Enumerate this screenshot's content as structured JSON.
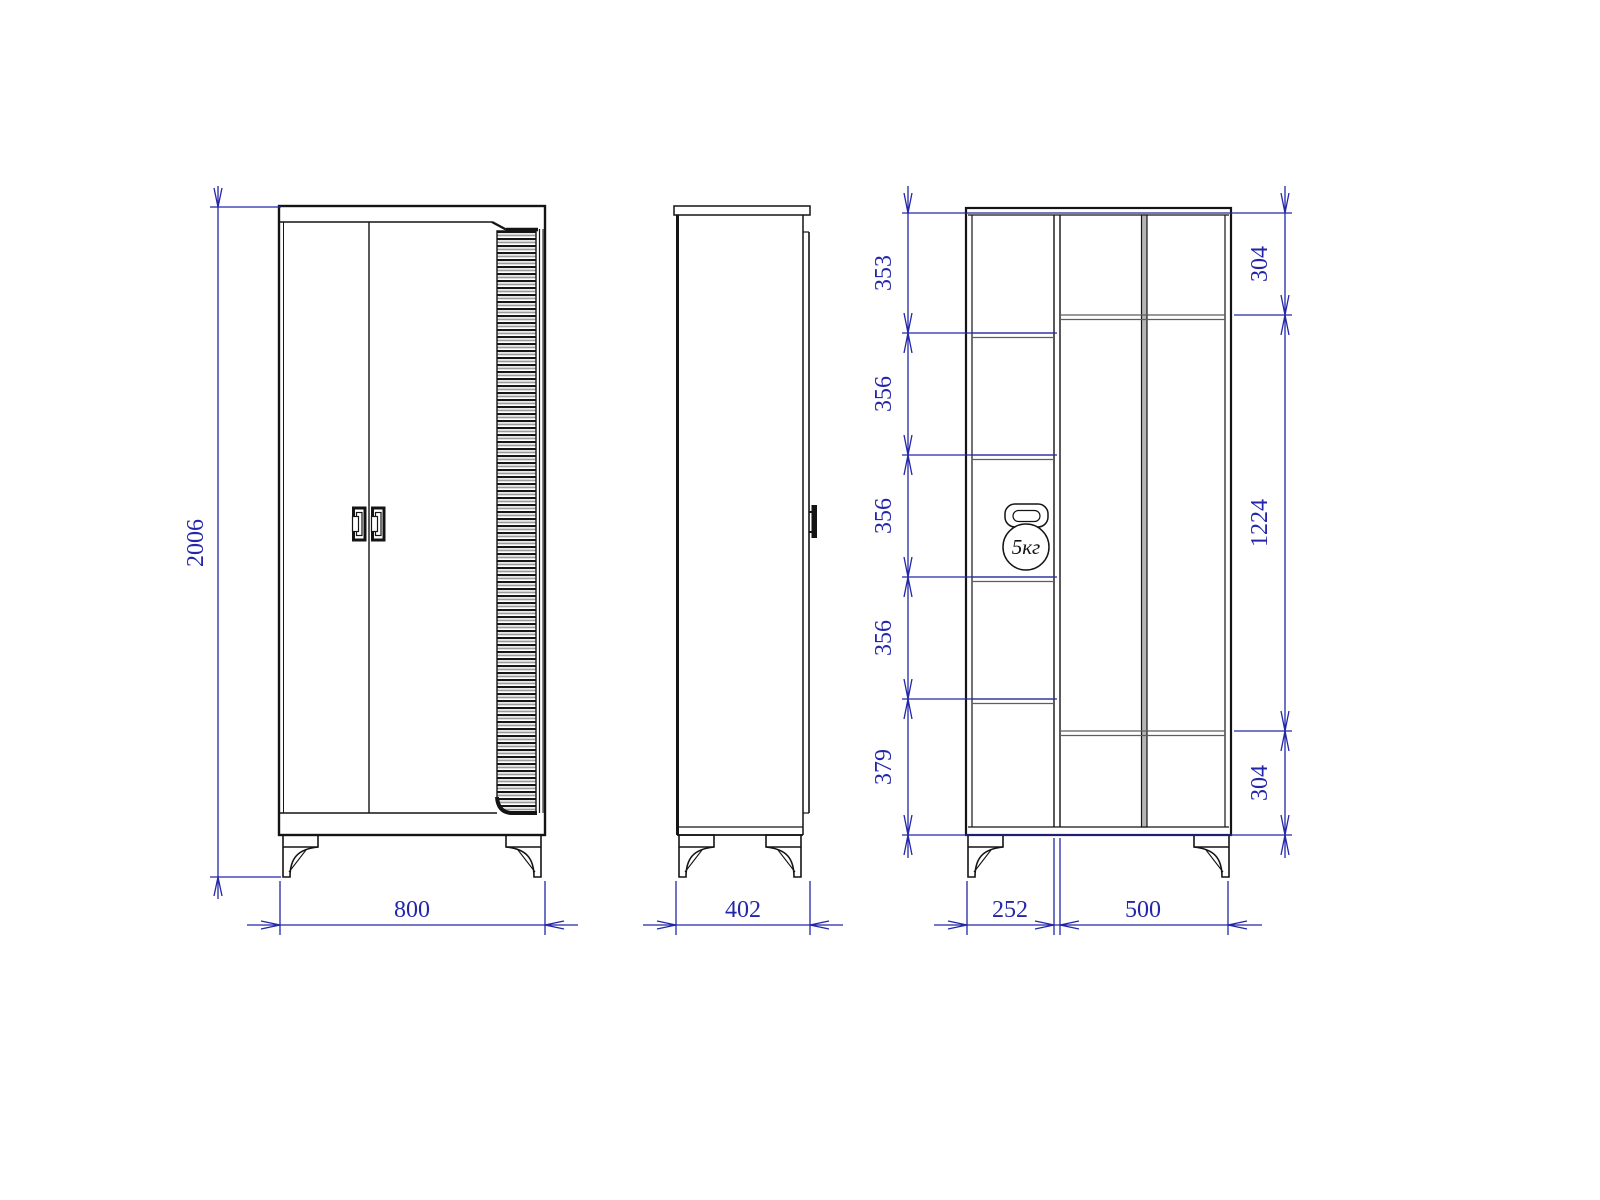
{
  "front": {
    "height": "2006",
    "width": "800"
  },
  "side": {
    "depth": "402"
  },
  "interior": {
    "left_segments": [
      "353",
      "356",
      "356",
      "356",
      "379"
    ],
    "right_segments": [
      "304",
      "1224",
      "304"
    ],
    "bottom_widths": [
      "252",
      "500"
    ],
    "load_label": "5кг"
  },
  "colors": {
    "dimension": "#2326a8",
    "line": "#141414",
    "gray": "#6b6b6b"
  }
}
